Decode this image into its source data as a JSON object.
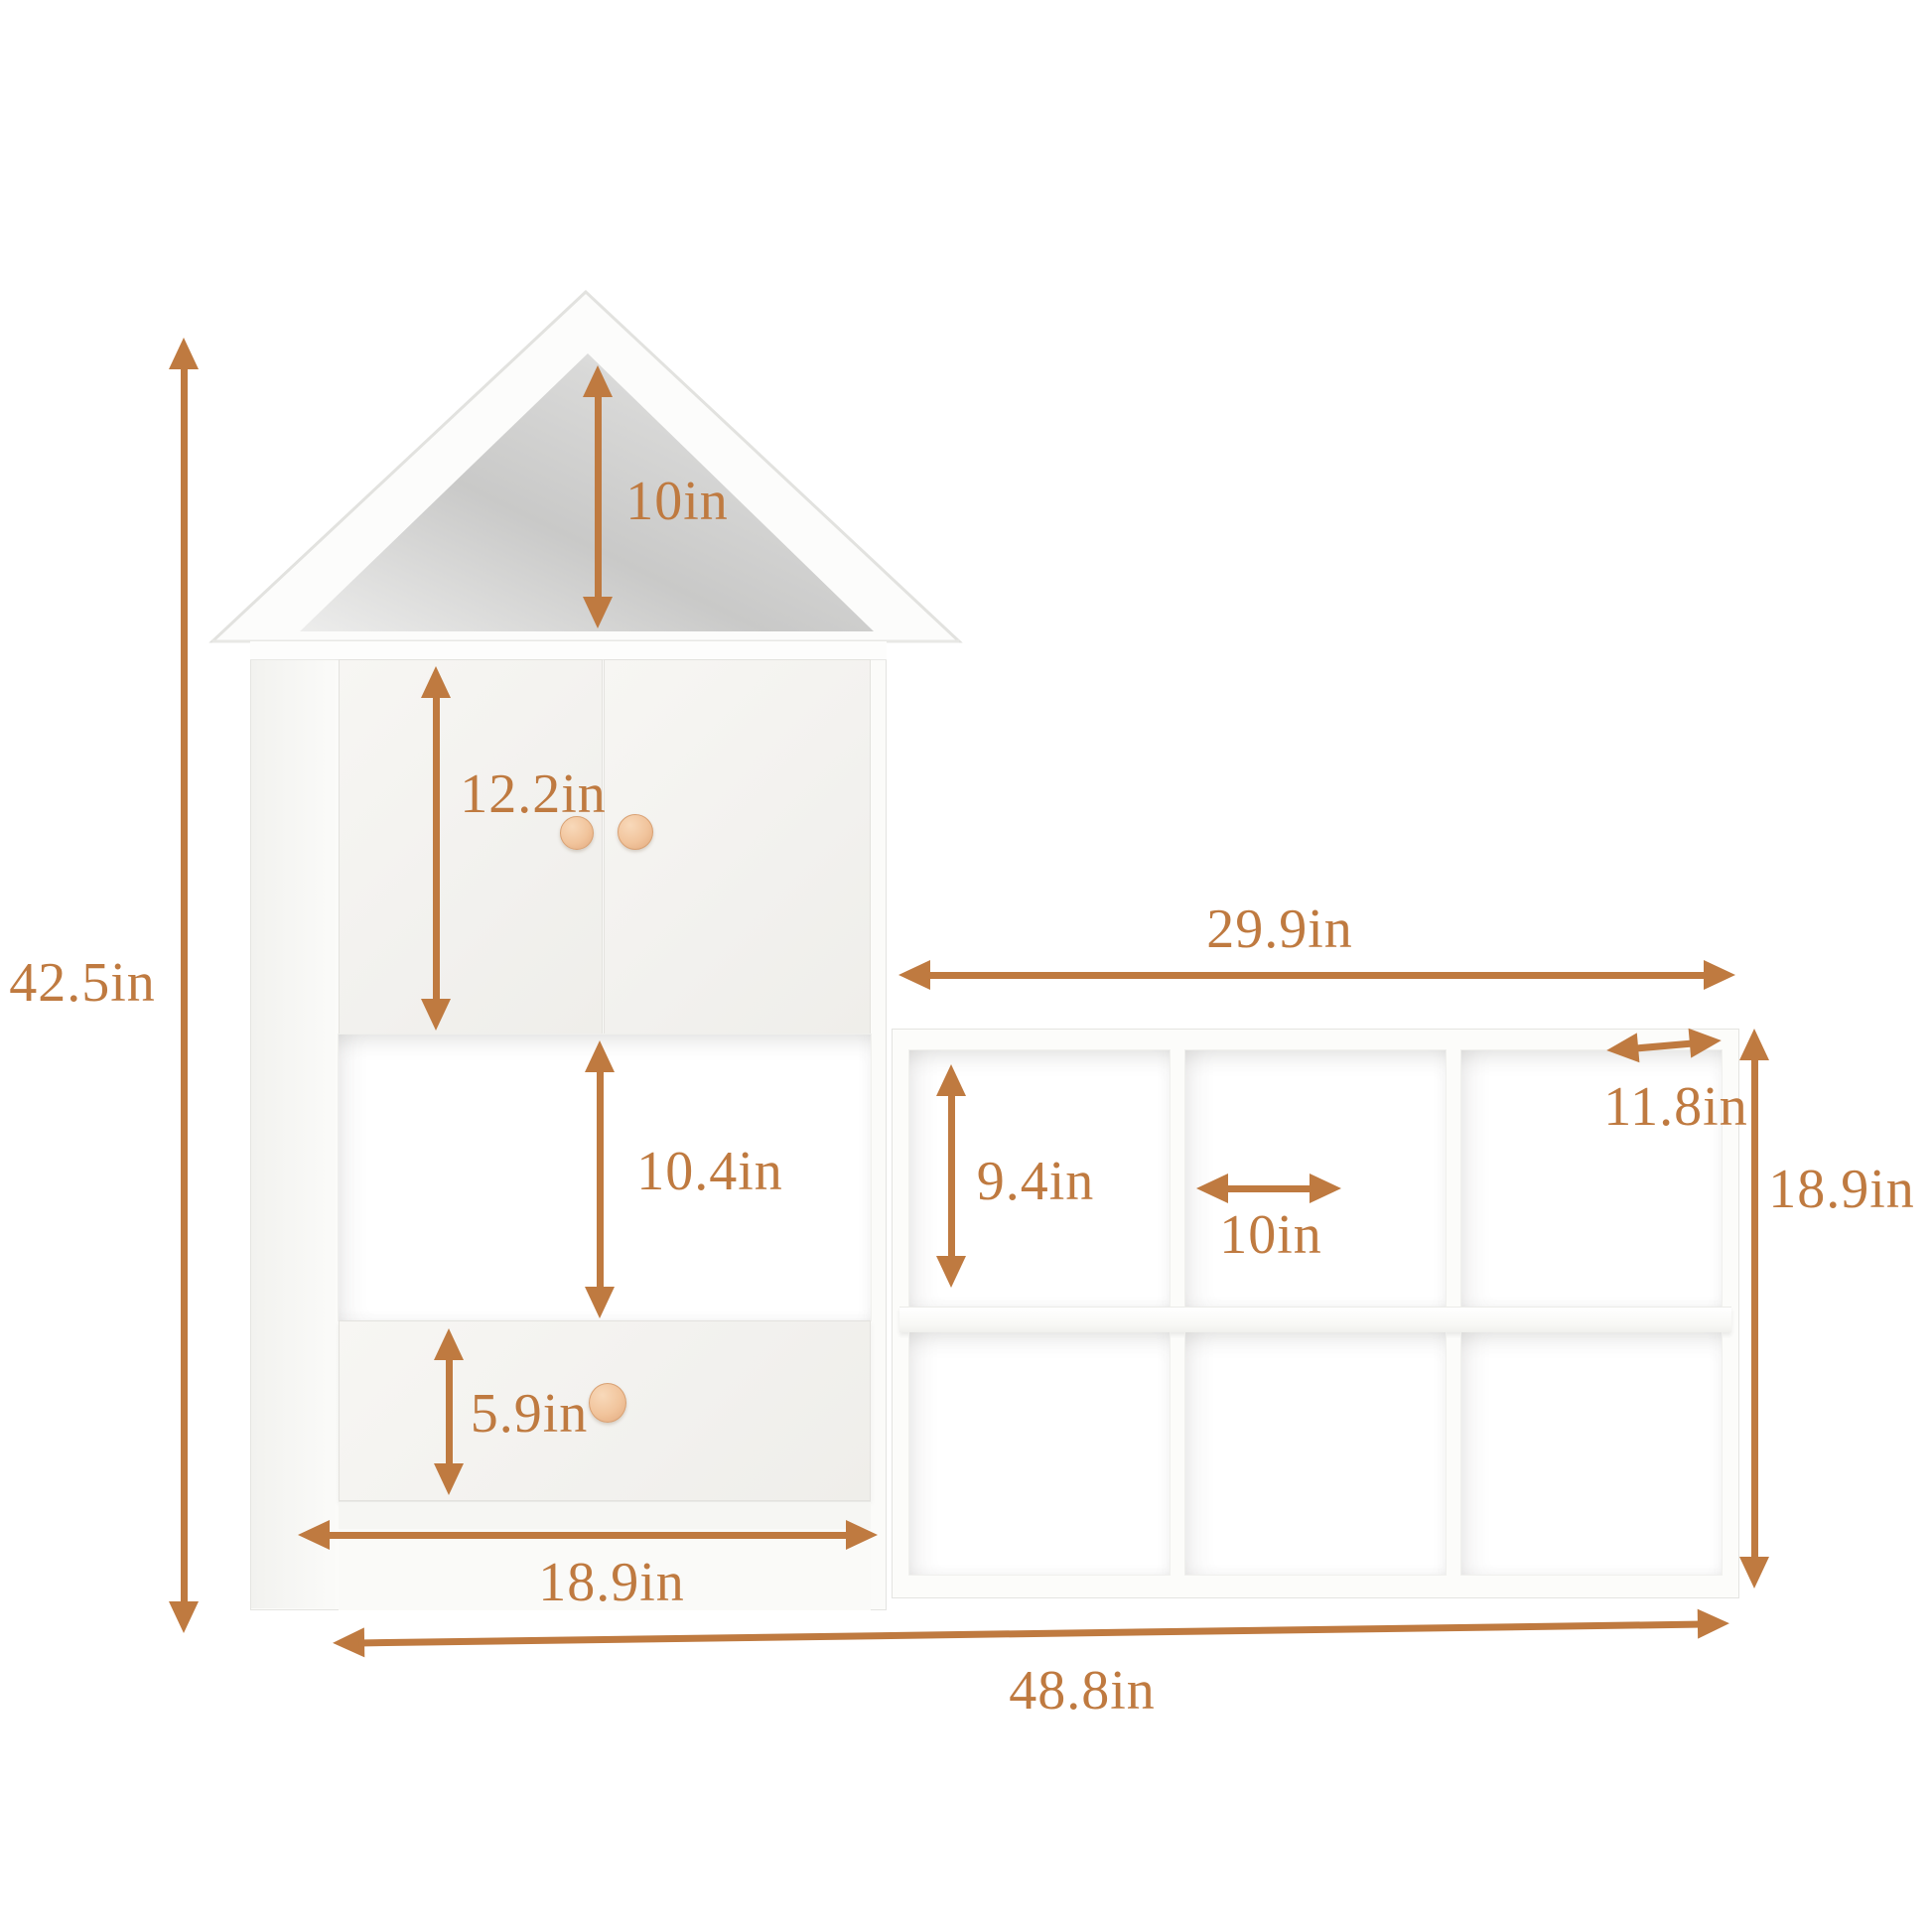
{
  "diagram": {
    "type": "furniture-dimension-diagram",
    "unit": "in",
    "colors": {
      "background": "#ffffff",
      "furniture": "#fbfbf9",
      "attic_shade": "#c9c9c8",
      "dimension": "#bf7a40",
      "knob": "#f1c49c"
    },
    "structure": {
      "cube_rows": 2,
      "cube_columns": 3,
      "door_count": 2,
      "drawer_count": 1
    },
    "dimensions": {
      "total_height": "42.5in",
      "roof_height": "10in",
      "door_height": "12.2in",
      "open_shelf_height": "10.4in",
      "drawer_height": "5.9in",
      "tower_width": "18.9in",
      "overall_width": "48.8in",
      "cube_unit_width": "29.9in",
      "cube_cell_height": "9.4in",
      "cube_cell_width": "10in",
      "cube_unit_depth": "11.8in",
      "cube_unit_height": "18.9in"
    }
  }
}
